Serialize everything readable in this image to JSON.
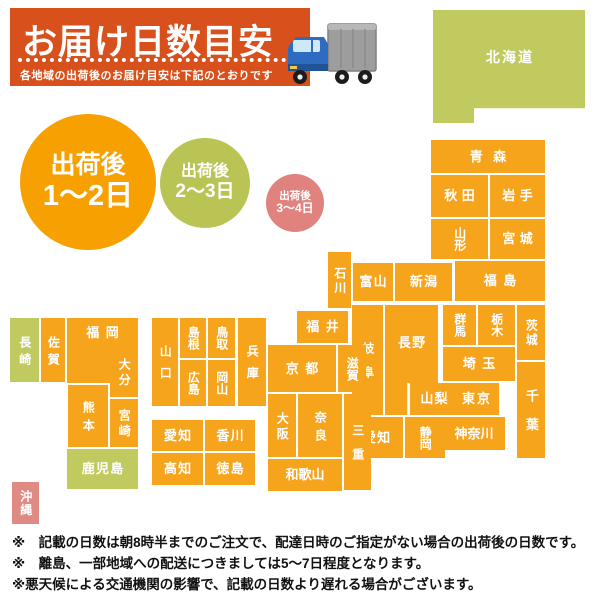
{
  "header": {
    "title": "お届け日数目安",
    "subtitle": "各地域の出荷後のお届け目安は下記のとおりです",
    "banner_color": "#d8511d"
  },
  "legend": {
    "items": [
      {
        "line1": "出荷後",
        "line2": "1～2日",
        "color": "#f6a101"
      },
      {
        "line1": "出荷後",
        "line2": "2～3日",
        "color": "#b9c455"
      },
      {
        "line1": "出荷後",
        "line2": "3～4日",
        "color": "#e0837e"
      }
    ]
  },
  "colors": {
    "orange": "#f7a41d",
    "green": "#c0ca5e",
    "pink": "#e08a84"
  },
  "map": {
    "prefectures": [
      {
        "name": "北海道",
        "x": 433,
        "y": 10,
        "w": 152,
        "h": 113,
        "c": "green",
        "o": "h",
        "fs": 14,
        "ls": 0.15,
        "clip": "polygon(0 0,100% 0,100% 87%,27% 87%,27% 100%,0 100%)",
        "pb": 18
      },
      {
        "name": "青森",
        "x": 431,
        "y": 140,
        "w": 114,
        "h": 33,
        "c": "orange",
        "o": "h",
        "fs": 13,
        "ls": 0.8
      },
      {
        "name": "秋田",
        "x": 431,
        "y": 175,
        "w": 57,
        "h": 42,
        "c": "orange",
        "o": "h",
        "fs": 13,
        "ls": 0.35
      },
      {
        "name": "岩手",
        "x": 490,
        "y": 175,
        "w": 55,
        "h": 42,
        "c": "orange",
        "o": "h",
        "fs": 13,
        "ls": 0.35
      },
      {
        "name": "山形",
        "x": 431,
        "y": 219,
        "w": 57,
        "h": 40,
        "c": "orange",
        "o": "v",
        "fs": 12
      },
      {
        "name": "宮城",
        "x": 490,
        "y": 219,
        "w": 55,
        "h": 40,
        "c": "orange",
        "o": "h",
        "fs": 13,
        "ls": 0.35
      },
      {
        "name": "福島",
        "x": 455,
        "y": 261,
        "w": 90,
        "h": 40,
        "c": "orange",
        "o": "h",
        "fs": 13,
        "ls": 0.5
      },
      {
        "name": "新潟",
        "x": 395,
        "y": 263,
        "w": 57,
        "h": 38,
        "c": "orange",
        "o": "h",
        "fs": 13,
        "ls": 0.1
      },
      {
        "name": "富山",
        "x": 353,
        "y": 263,
        "w": 40,
        "h": 38,
        "c": "orange",
        "o": "h",
        "fs": 13,
        "ls": 0.1
      },
      {
        "name": "石川",
        "x": 328,
        "y": 252,
        "w": 23,
        "h": 56,
        "c": "orange",
        "o": "v",
        "fs": 12,
        "ls": 0.2
      },
      {
        "name": "福井",
        "x": 297,
        "y": 311,
        "w": 51,
        "h": 32,
        "c": "orange",
        "o": "h",
        "fs": 13,
        "ls": 0.5
      },
      {
        "name": "群馬",
        "x": 443,
        "y": 305,
        "w": 33,
        "h": 40,
        "c": "orange",
        "o": "v",
        "fs": 12
      },
      {
        "name": "栃木",
        "x": 478,
        "y": 305,
        "w": 37,
        "h": 40,
        "c": "orange",
        "o": "v",
        "fs": 12
      },
      {
        "name": "茨城",
        "x": 517,
        "y": 305,
        "w": 28,
        "h": 55,
        "c": "orange",
        "o": "v",
        "fs": 12,
        "ls": 0.2
      },
      {
        "name": "埼玉",
        "x": 443,
        "y": 347,
        "w": 72,
        "h": 34,
        "c": "orange",
        "o": "h",
        "fs": 13,
        "ls": 0.5
      },
      {
        "name": "千葉",
        "x": 517,
        "y": 362,
        "w": 28,
        "h": 96,
        "c": "orange",
        "o": "v",
        "fs": 13,
        "ls": 1.2
      },
      {
        "name": "東京",
        "x": 453,
        "y": 383,
        "w": 46,
        "h": 32,
        "c": "orange",
        "o": "h",
        "fs": 13,
        "ls": 0.15
      },
      {
        "name": "山梨",
        "x": 410,
        "y": 383,
        "w": 48,
        "h": 32,
        "c": "orange",
        "o": "h",
        "fs": 13,
        "ls": 0.1
      },
      {
        "name": "神奈川",
        "x": 443,
        "y": 417,
        "w": 62,
        "h": 33,
        "c": "orange",
        "o": "h",
        "fs": 13
      },
      {
        "name": "静岡",
        "x": 405,
        "y": 417,
        "w": 40,
        "h": 41,
        "c": "orange",
        "o": "v",
        "fs": 12
      },
      {
        "name": "愛知",
        "x": 350,
        "y": 417,
        "w": 53,
        "h": 41,
        "c": "orange",
        "o": "h",
        "fs": 13,
        "ls": 0.1
      },
      {
        "name": "長野",
        "x": 385,
        "y": 305,
        "w": 53,
        "h": 110,
        "c": "orange",
        "o": "h",
        "fs": 13,
        "ls": 0.1,
        "clip": "polygon(0 0,100% 0,100% 71%,42% 71%,42% 100%,0 100%)",
        "pb": 34
      },
      {
        "name": "岐阜",
        "x": 352,
        "y": 305,
        "w": 31,
        "h": 110,
        "c": "orange",
        "o": "v",
        "fs": 12,
        "ls": 1.0
      },
      {
        "name": "滋賀",
        "x": 338,
        "y": 345,
        "w": 28,
        "h": 47,
        "c": "orange",
        "o": "v",
        "fs": 12
      },
      {
        "name": "京都",
        "x": 268,
        "y": 345,
        "w": 68,
        "h": 47,
        "c": "orange",
        "o": "h",
        "fs": 13,
        "ls": 0.5
      },
      {
        "name": "大阪",
        "x": 268,
        "y": 394,
        "w": 28,
        "h": 63,
        "c": "orange",
        "o": "v",
        "fs": 12,
        "ls": 0.3
      },
      {
        "name": "奈良",
        "x": 298,
        "y": 394,
        "w": 44,
        "h": 63,
        "c": "orange",
        "o": "v",
        "fs": 12,
        "ls": 0.5
      },
      {
        "name": "三重",
        "x": 344,
        "y": 394,
        "w": 27,
        "h": 96,
        "c": "orange",
        "o": "v",
        "fs": 12,
        "ls": 1.0
      },
      {
        "name": "和歌山",
        "x": 268,
        "y": 459,
        "w": 74,
        "h": 32,
        "c": "orange",
        "o": "h",
        "fs": 13
      },
      {
        "name": "兵庫",
        "x": 238,
        "y": 318,
        "w": 28,
        "h": 88,
        "c": "orange",
        "o": "v",
        "fs": 12,
        "ls": 0.8
      },
      {
        "name": "鳥取",
        "x": 208,
        "y": 318,
        "w": 27,
        "h": 40,
        "c": "orange",
        "o": "v",
        "fs": 12
      },
      {
        "name": "島根",
        "x": 180,
        "y": 318,
        "w": 26,
        "h": 40,
        "c": "orange",
        "o": "v",
        "fs": 12
      },
      {
        "name": "岡山",
        "x": 208,
        "y": 360,
        "w": 27,
        "h": 46,
        "c": "orange",
        "o": "v",
        "fs": 12
      },
      {
        "name": "広島",
        "x": 180,
        "y": 360,
        "w": 26,
        "h": 46,
        "c": "orange",
        "o": "v",
        "fs": 12
      },
      {
        "name": "山口",
        "x": 152,
        "y": 318,
        "w": 26,
        "h": 88,
        "c": "orange",
        "o": "v",
        "fs": 12,
        "ls": 0.8
      },
      {
        "name": "愛知",
        "x": 152,
        "y": 420,
        "w": 51,
        "h": 31,
        "c": "orange",
        "o": "h",
        "fs": 13,
        "ls": 0.1
      },
      {
        "name": "香川",
        "x": 205,
        "y": 420,
        "w": 50,
        "h": 31,
        "c": "orange",
        "o": "h",
        "fs": 13,
        "ls": 0.1
      },
      {
        "name": "高知",
        "x": 152,
        "y": 453,
        "w": 51,
        "h": 32,
        "c": "orange",
        "o": "h",
        "fs": 13,
        "ls": 0.1
      },
      {
        "name": "徳島",
        "x": 205,
        "y": 453,
        "w": 50,
        "h": 32,
        "c": "orange",
        "o": "h",
        "fs": 13,
        "ls": 0.1
      },
      {
        "name": "福岡",
        "x": 67,
        "y": 318,
        "w": 71,
        "h": 65,
        "c": "orange",
        "o": "h",
        "fs": 13,
        "ls": 0.5,
        "clip": "polygon(0 0,100% 0,100% 46%,62% 46%,62% 100%,0 100%)",
        "pb": 36
      },
      {
        "name": "佐賀",
        "x": 41,
        "y": 318,
        "w": 24,
        "h": 64,
        "c": "orange",
        "o": "v",
        "fs": 12,
        "ls": 0.4
      },
      {
        "name": "長崎",
        "x": 10,
        "y": 318,
        "w": 29,
        "h": 64,
        "c": "green",
        "o": "v",
        "fs": 12,
        "ls": 0.4
      },
      {
        "name": "大分",
        "x": 110,
        "y": 347,
        "w": 28,
        "h": 50,
        "c": "orange",
        "o": "v",
        "fs": 12,
        "ls": 0.3
      },
      {
        "name": "宮崎",
        "x": 110,
        "y": 399,
        "w": 28,
        "h": 48,
        "c": "orange",
        "o": "v",
        "fs": 12,
        "ls": 0.3
      },
      {
        "name": "熊本",
        "x": 68,
        "y": 385,
        "w": 40,
        "h": 62,
        "c": "orange",
        "o": "v",
        "fs": 12,
        "ls": 0.5
      },
      {
        "name": "鹿児島",
        "x": 67,
        "y": 449,
        "w": 71,
        "h": 40,
        "c": "green",
        "o": "h",
        "fs": 13,
        "ls": 0.1
      },
      {
        "name": "沖縄",
        "x": 12,
        "y": 482,
        "w": 27,
        "h": 42,
        "c": "pink",
        "o": "v",
        "fs": 12,
        "ls": 0.1
      }
    ]
  },
  "notes": [
    "※　記載の日数は朝8時半までのご注文で、配達日時のご指定がない場合の出荷後の日数です。",
    "※　離島、一部地域への配送につきましては5～7日程度となります。",
    "※悪天候による交通機関の影響で、記載の日数より遅れる場合がございます。"
  ]
}
